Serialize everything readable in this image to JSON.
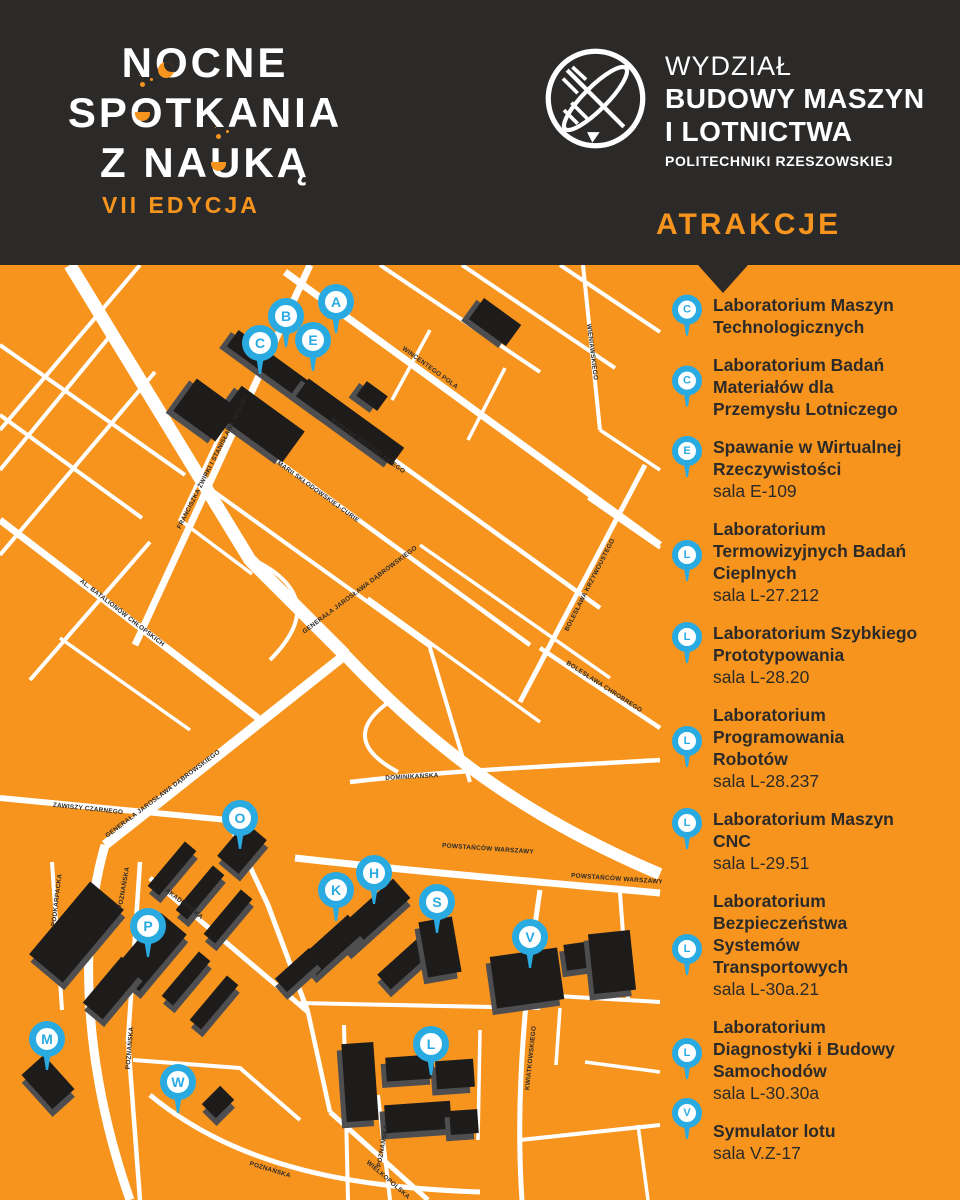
{
  "colors": {
    "orange": "#F7941E",
    "dark": "#2B2A29",
    "blue": "#29ABE2",
    "white": "#FFFFFF",
    "building": "#1D1C1B",
    "building_side": "#4E4E50"
  },
  "header": {
    "brand_lines": [
      "NOCNE",
      "SPOTKANIA",
      "Z NAUKĄ"
    ],
    "edition": "VII EDYCJA",
    "faculty_lines": [
      "WYDZIAŁ",
      "BUDOWY MASZYN",
      "I LOTNICTWA",
      "POLITECHNIKI RZESZOWSKIEJ"
    ],
    "attractions_heading": "ATRAKCJE"
  },
  "attractions": [
    {
      "letter": "C",
      "title": [
        "Laboratorium Maszyn",
        "Technologicznych"
      ],
      "sala": null
    },
    {
      "letter": "C",
      "title": [
        "Laboratorium Badań",
        "Materiałów dla",
        "Przemysłu Lotniczego"
      ],
      "sala": null
    },
    {
      "letter": "E",
      "title": [
        "Spawanie w Wirtualnej",
        "Rzeczywistości"
      ],
      "sala": "sala E-109"
    },
    {
      "letter": "L",
      "title": [
        "Laboratorium",
        "Termowizyjnych Badań",
        "Cieplnych"
      ],
      "sala": "sala L-27.212"
    },
    {
      "letter": "L",
      "title": [
        "Laboratorium Szybkiego",
        "Prototypowania"
      ],
      "sala": "sala L-28.20"
    },
    {
      "letter": "L",
      "title": [
        "Laboratorium",
        "Programowania",
        "Robotów"
      ],
      "sala": "sala L-28.237"
    },
    {
      "letter": "L",
      "title": [
        "Laboratorium Maszyn",
        "CNC"
      ],
      "sala": "sala L-29.51"
    },
    {
      "letter": "L",
      "title": [
        "Laboratorium",
        "Bezpieczeństwa",
        "Systemów",
        "Transportowych"
      ],
      "sala": "sala L-30a.21"
    },
    {
      "letter": "L",
      "title": [
        "Laboratorium",
        "Diagnostyki i Budowy",
        "Samochodów"
      ],
      "sala": "sala L-30.30a"
    },
    {
      "letter": "V",
      "title": [
        "Symulator lotu"
      ],
      "sala": "sala V.Z-17"
    }
  ],
  "map": {
    "roads": [
      {
        "d": "M70 265 L250 560 L345 655",
        "w": 13
      },
      {
        "d": "M345 655 L105 845",
        "w": 10
      },
      {
        "d": "M345 655 C430 745 520 815 660 874",
        "w": 12
      },
      {
        "d": "M105 845 C75 950 88 1080 130 1200",
        "w": 9
      },
      {
        "d": "M295 858 C420 872 540 882 660 893",
        "w": 7
      },
      {
        "d": "M0 798 L228 820",
        "w": 6
      },
      {
        "d": "M285 272 L660 545",
        "w": 7
      },
      {
        "d": "M135 645 L310 265",
        "w": 7
      },
      {
        "d": "M0 520 L258 718",
        "w": 7
      },
      {
        "d": "M300 392 L600 608",
        "w": 4.5
      },
      {
        "d": "M252 442 L530 645",
        "w": 4.5
      },
      {
        "d": "M195 478 L432 648",
        "w": 4
      },
      {
        "d": "M520 702 L645 465",
        "w": 5
      },
      {
        "d": "M540 648 L660 728",
        "w": 4.5
      },
      {
        "d": "M350 782 C450 770 560 766 660 760",
        "w": 4.5
      },
      {
        "d": "M540 890 C525 990 515 1100 522 1200",
        "w": 5
      },
      {
        "d": "M150 878 L308 1012",
        "w": 5
      },
      {
        "d": "M150 1095 C240 1170 360 1188 480 1192",
        "w": 5
      },
      {
        "d": "M330 1112 L428 1200",
        "w": 5
      },
      {
        "d": "M378 1095 L390 1200",
        "w": 4
      },
      {
        "d": "M0 430 L140 265",
        "w": 4
      },
      {
        "d": "M0 555 L155 372",
        "w": 4
      },
      {
        "d": "M0 470 L115 330",
        "w": 4
      },
      {
        "d": "M30 680 L150 542",
        "w": 4
      },
      {
        "d": "M0 345 L185 475",
        "w": 4
      },
      {
        "d": "M0 415 L142 518",
        "w": 4
      },
      {
        "d": "M60 638 L190 730",
        "w": 3.5
      },
      {
        "d": "M222 430 L180 520 L252 574",
        "w": 3.5
      },
      {
        "d": "M380 265 L540 372",
        "w": 4
      },
      {
        "d": "M462 265 L615 368",
        "w": 4
      },
      {
        "d": "M560 265 L660 332",
        "w": 4
      },
      {
        "d": "M583 265 L600 430",
        "w": 4
      },
      {
        "d": "M600 430 L660 470",
        "w": 3.5
      },
      {
        "d": "M430 330 L392 400",
        "w": 3.5
      },
      {
        "d": "M505 368 L468 440",
        "w": 3.5
      },
      {
        "d": "M420 545 L610 678",
        "w": 3.5
      },
      {
        "d": "M368 598 L540 722",
        "w": 3.5
      },
      {
        "d": "M588 498 L660 548",
        "w": 3.5
      },
      {
        "d": "M258 562 Q330 600 270 660",
        "w": 4
      },
      {
        "d": "M392 700 Q335 738 398 772",
        "w": 4
      },
      {
        "d": "M52 862 L62 1010",
        "w": 4
      },
      {
        "d": "M140 862 L128 1040 L140 1200",
        "w": 4.5
      },
      {
        "d": "M133 1060 L240 1068 L300 1120",
        "w": 4
      },
      {
        "d": "M228 820 L268 905 L308 1012",
        "w": 5
      },
      {
        "d": "M308 1012 L330 1112",
        "w": 4.5
      },
      {
        "d": "M344 1025 L348 1200",
        "w": 4
      },
      {
        "d": "M300 1003 L540 1008",
        "w": 4
      },
      {
        "d": "M480 1030 L478 1140",
        "w": 3.5
      },
      {
        "d": "M430 648 L470 782",
        "w": 4
      },
      {
        "d": "M540 995 L660 1002",
        "w": 4
      },
      {
        "d": "M620 893 L628 1000",
        "w": 4
      },
      {
        "d": "M585 1062 L660 1072",
        "w": 3.5
      },
      {
        "d": "M520 1140 L660 1125",
        "w": 4
      },
      {
        "d": "M638 1125 L648 1200",
        "w": 3.5
      },
      {
        "d": "M560 1008 L556 1065",
        "w": 3.5
      }
    ],
    "buildings": [
      [
        282,
        374,
        122,
        20,
        36
      ],
      [
        350,
        422,
        118,
        22,
        36
      ],
      [
        262,
        424,
        78,
        38,
        36
      ],
      [
        206,
        410,
        52,
        40,
        36
      ],
      [
        372,
        396,
        26,
        18,
        36
      ],
      [
        495,
        322,
        46,
        26,
        36
      ],
      [
        242,
        848,
        44,
        28,
        -50
      ],
      [
        172,
        868,
        58,
        15,
        -50
      ],
      [
        200,
        892,
        58,
        15,
        -50
      ],
      [
        228,
        916,
        58,
        15,
        -50
      ],
      [
        186,
        978,
        58,
        15,
        -50
      ],
      [
        214,
        1002,
        58,
        15,
        -50
      ],
      [
        150,
        952,
        74,
        34,
        -50
      ],
      [
        76,
        932,
        95,
        44,
        -50
      ],
      [
        112,
        988,
        60,
        26,
        -50
      ],
      [
        372,
        915,
        80,
        26,
        -42
      ],
      [
        332,
        945,
        64,
        24,
        -42
      ],
      [
        298,
        970,
        46,
        18,
        -42
      ],
      [
        404,
        964,
        54,
        20,
        -42
      ],
      [
        440,
        947,
        34,
        56,
        -10
      ],
      [
        527,
        978,
        68,
        52,
        -8
      ],
      [
        578,
        956,
        26,
        26,
        -8
      ],
      [
        612,
        962,
        42,
        60,
        -6
      ],
      [
        48,
        1082,
        30,
        46,
        -42
      ],
      [
        218,
        1102,
        26,
        20,
        -45
      ],
      [
        360,
        1082,
        32,
        78,
        -4
      ],
      [
        410,
        1068,
        48,
        24,
        -4
      ],
      [
        455,
        1074,
        38,
        28,
        -4
      ],
      [
        418,
        1117,
        66,
        28,
        -4
      ],
      [
        464,
        1122,
        28,
        24,
        -4
      ]
    ],
    "street_labels": [
      [
        "WINCENTEGO POLA",
        430,
        368,
        36
      ],
      [
        "ROMANA NIEDZIELSKIEGO",
        368,
        446,
        36
      ],
      [
        "MARII SKŁODOWSKIEJ-CURIE",
        318,
        492,
        36
      ],
      [
        "FRANCISZKA ŻWIRKI I STANISŁAWA WIGURY",
        213,
        462,
        -63
      ],
      [
        "GENERAŁA JAROSŁAWA DĄBROWSKIEGO",
        360,
        590,
        -37
      ],
      [
        "AL. BATALIONÓW CHŁOPSKICH",
        122,
        613,
        38
      ],
      [
        "WIENIAWSKIEGO",
        592,
        352,
        83
      ],
      [
        "BOLESŁAWA KRZYWOUSTEGO",
        590,
        585,
        -63
      ],
      [
        "BOLESŁAWA CHROBREGO",
        604,
        687,
        33
      ],
      [
        "ZAWISZY CZARNEGO",
        88,
        809,
        6
      ],
      [
        "GENERAŁA JAROSŁAWA DĄBROWSKIEGO",
        163,
        794,
        -37
      ],
      [
        "DOMINIKAŃSKA",
        412,
        777,
        -3
      ],
      [
        "POWSTAŃCÓW WARSZAWY",
        488,
        849,
        4
      ],
      [
        "POWSTAŃCÓW WARSZAWY",
        617,
        879,
        4
      ],
      [
        "PODKARPACKA",
        57,
        900,
        -83
      ],
      [
        "POZNAŃSKA",
        124,
        888,
        -80
      ],
      [
        "AKADEMICKA",
        184,
        904,
        38
      ],
      [
        "POZNAŃSKA",
        130,
        1048,
        -85
      ],
      [
        "POZNAŃSKA",
        270,
        1170,
        17
      ],
      [
        "POZNAŃSKA",
        383,
        1146,
        -80
      ],
      [
        "WIELKOPOLSKA",
        388,
        1180,
        41
      ],
      [
        "KWIATKOWSKIEGO",
        531,
        1058,
        -84
      ]
    ],
    "pins": [
      [
        "A",
        336,
        302
      ],
      [
        "B",
        286,
        316
      ],
      [
        "C",
        260,
        343
      ],
      [
        "E",
        313,
        340
      ],
      [
        "O",
        240,
        818
      ],
      [
        "H",
        374,
        873
      ],
      [
        "K",
        336,
        890
      ],
      [
        "S",
        437,
        902
      ],
      [
        "P",
        148,
        926
      ],
      [
        "V",
        530,
        937
      ],
      [
        "M",
        47,
        1039
      ],
      [
        "L",
        431,
        1044
      ],
      [
        "W",
        178,
        1082
      ]
    ]
  }
}
